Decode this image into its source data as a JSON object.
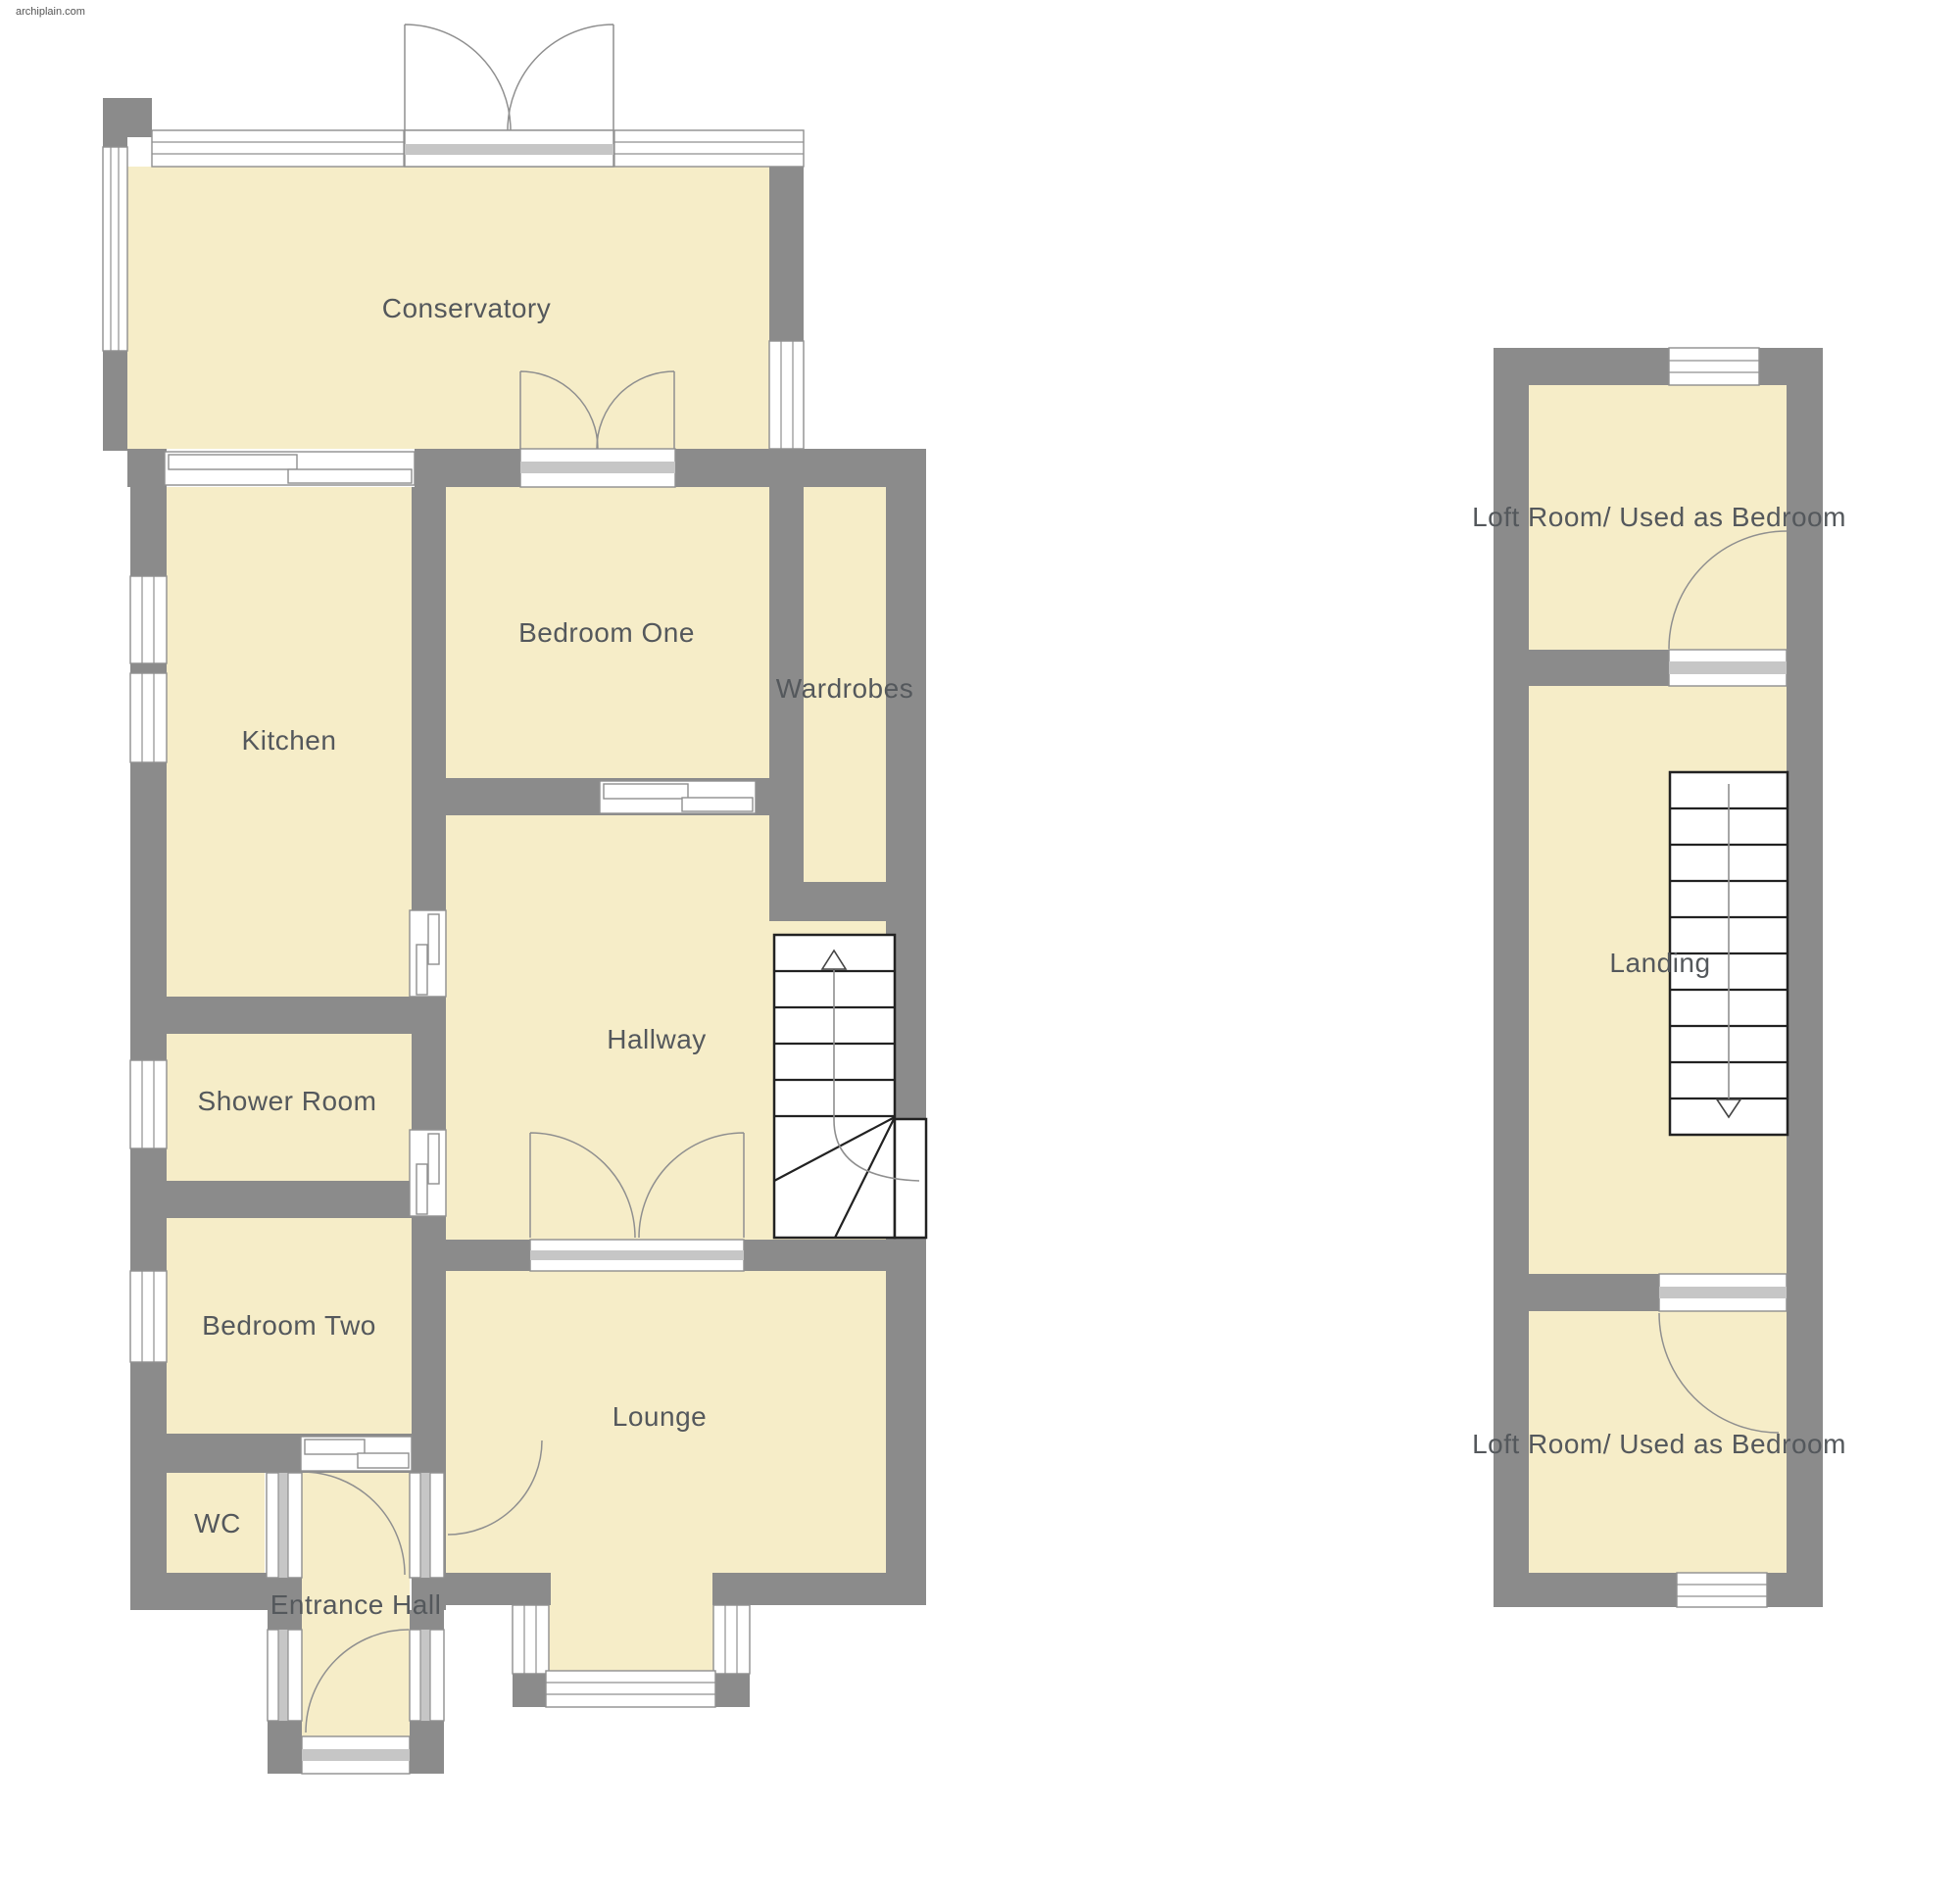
{
  "watermark": "archiplain.com",
  "colors": {
    "wall": "#8b8b8b",
    "floor": "#f6edc8",
    "threshold": "#c6c6c6",
    "line": "#8f8f8f",
    "stair": "#222222",
    "label": "#54585c",
    "background": "#ffffff"
  },
  "ground_floor": {
    "rooms": {
      "conservatory": "Conservatory",
      "kitchen": "Kitchen",
      "bedroom_one": "Bedroom One",
      "wardrobes": "Wardrobes",
      "hallway": "Hallway",
      "shower_room": "Shower Room",
      "bedroom_two": "Bedroom Two",
      "wc": "WC",
      "entrance_hall": "Entrance Hall",
      "lounge": "Lounge"
    },
    "stairs": {
      "direction": "up",
      "treads": 6,
      "winder": true
    }
  },
  "first_floor": {
    "rooms": {
      "loft_room_top": "Loft Room/ Used as Bedroom",
      "landing": "Landing",
      "loft_room_bottom": "Loft Room/ Used as Bedroom"
    },
    "stairs": {
      "direction": "down",
      "treads": 10,
      "winder": false
    }
  }
}
